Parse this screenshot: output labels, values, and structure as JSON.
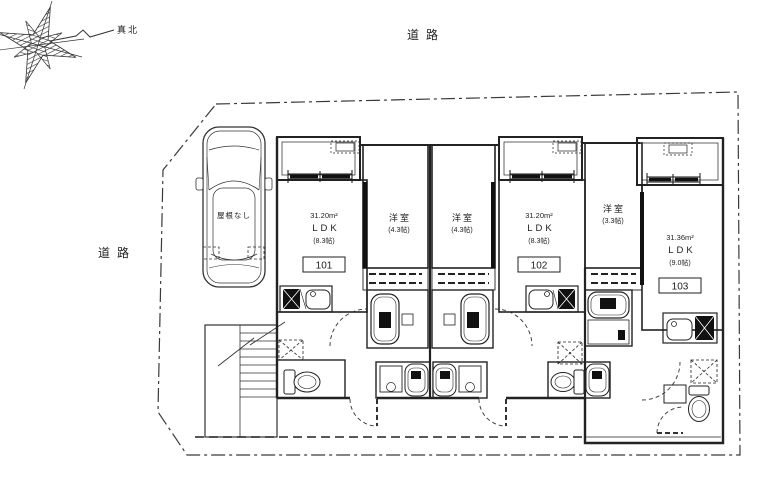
{
  "plan": {
    "north_label": "真北",
    "road_top_label": "道路",
    "road_left_label": "道路",
    "parking_label": "屋根なし",
    "units": [
      {
        "number": "101",
        "area": "31.20m²",
        "type": "LDK",
        "type_size": "(8.3帖)",
        "bedroom_name": "洋室",
        "bedroom_size": "(4.3帖)"
      },
      {
        "number": "102",
        "area": "31.20m²",
        "type": "LDK",
        "type_size": "(8.3帖)",
        "bedroom_name": "洋室",
        "bedroom_size": "(4.3帖)"
      },
      {
        "number": "103",
        "area": "31.36m²",
        "type": "LDK",
        "type_size": "(9.0帖)",
        "bedroom_name": "洋室",
        "bedroom_size": "(3.3帖)"
      }
    ]
  }
}
